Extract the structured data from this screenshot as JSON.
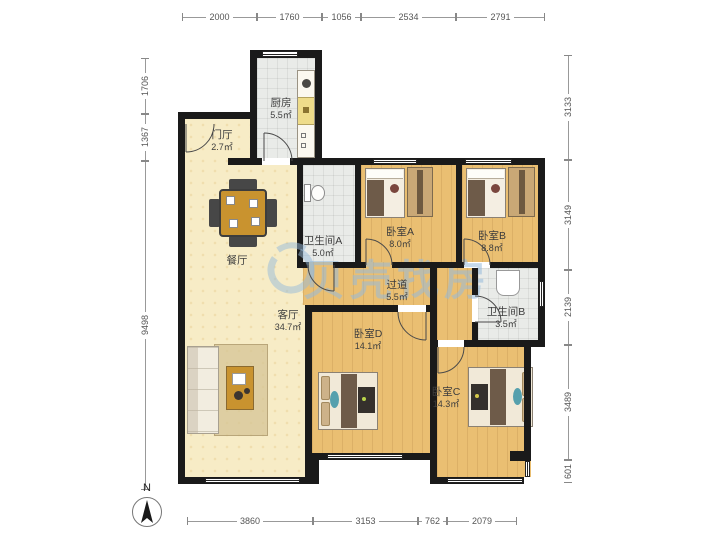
{
  "watermark": {
    "brand": "贝壳找房",
    "logo": "beike-house-logo"
  },
  "compass": {
    "label": "N"
  },
  "dimensions": {
    "top": [
      "2000",
      "1760",
      "1056",
      "2534",
      "2791"
    ],
    "left": [
      "1706",
      "1367",
      "9498"
    ],
    "right": [
      "3133",
      "3149",
      "2139",
      "3489",
      "601"
    ],
    "bottom": [
      "3860",
      "3153",
      "762",
      "2079"
    ]
  },
  "rooms": {
    "menting": {
      "name": "门厅",
      "area": "2.7㎡"
    },
    "chufang": {
      "name": "厨房",
      "area": "5.5㎡"
    },
    "bathA": {
      "name": "卫生间A",
      "area": "5.0㎡"
    },
    "bedA": {
      "name": "卧室A",
      "area": "8.0㎡"
    },
    "bedB": {
      "name": "卧室B",
      "area": "8.8㎡"
    },
    "guodao": {
      "name": "过道",
      "area": "5.5㎡"
    },
    "bathB": {
      "name": "卫生间B",
      "area": "3.5㎡"
    },
    "canting": {
      "name": "餐厅",
      "area": ""
    },
    "keting": {
      "name": "客厅",
      "area": "34.7㎡"
    },
    "bedD": {
      "name": "卧室D",
      "area": "14.1㎡"
    },
    "bedC": {
      "name": "卧室C",
      "area": "14.3㎡"
    }
  },
  "colors": {
    "wall": "#1a1a1a",
    "wood": "#eabf72",
    "cream": "#f7ecc6",
    "tile": "#e9ebe8",
    "watermark": "#96b9da"
  }
}
